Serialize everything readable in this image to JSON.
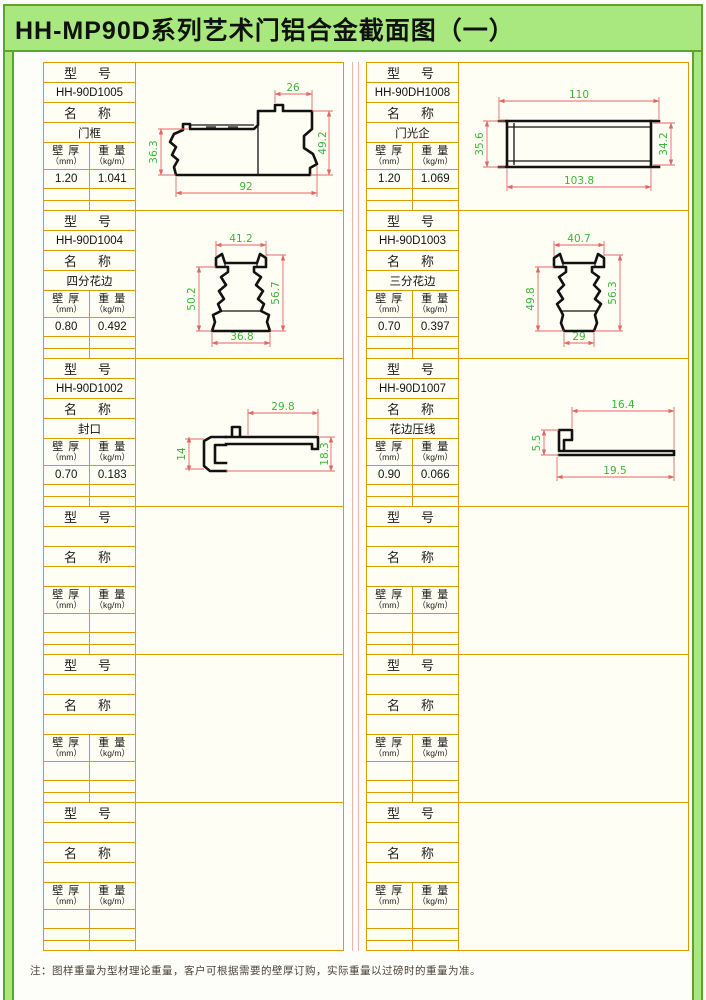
{
  "title": "HH-MP90D系列艺术门铝合金截面图（一）",
  "note": "注：图样重量为型材理论重量，客户可根据需要的壁厚订购，实际重量以过磅时的重量为准。",
  "labels": {
    "model_header": "型　号",
    "name_header": "名　称",
    "thickness_1": "壁 厚",
    "thickness_2": "（mm）",
    "weight_1": "重 量",
    "weight_2": "（kg/m）"
  },
  "colors": {
    "frame_green": "#a9e87e",
    "frame_edge_green": "#5ea32b",
    "table_border_orange": "#dd9a00",
    "cell_background": "#fffef4",
    "dimension_line_red": "#e06666",
    "dimension_text_green": "#3fb43a"
  },
  "entries_left": [
    {
      "model": "HH-90D1005",
      "name": "门框",
      "thickness": "1.20",
      "weight": "1.041",
      "dims": {
        "top": "26",
        "bottom": "92",
        "left": "36.3",
        "right": "49.2"
      }
    },
    {
      "model": "HH-90D1004",
      "name": "四分花边",
      "thickness": "0.80",
      "weight": "0.492",
      "dims": {
        "top": "41.2",
        "bottom": "36.8",
        "left": "50.2",
        "right": "56.7"
      }
    },
    {
      "model": "HH-90D1002",
      "name": "封口",
      "thickness": "0.70",
      "weight": "0.183",
      "dims": {
        "top": "29.8",
        "left": "14",
        "right": "18.3"
      }
    },
    {
      "model": "",
      "name": "",
      "thickness": "",
      "weight": ""
    },
    {
      "model": "",
      "name": "",
      "thickness": "",
      "weight": ""
    },
    {
      "model": "",
      "name": "",
      "thickness": "",
      "weight": ""
    }
  ],
  "entries_right": [
    {
      "model": "HH-90DH1008",
      "name": "门光企",
      "thickness": "1.20",
      "weight": "1.069",
      "dims": {
        "top": "110",
        "bottom": "103.8",
        "left": "35.6",
        "right": "34.2"
      }
    },
    {
      "model": "HH-90D1003",
      "name": "三分花边",
      "thickness": "0.70",
      "weight": "0.397",
      "dims": {
        "top": "40.7",
        "bottom": "29",
        "left": "49.8",
        "right": "56.3"
      }
    },
    {
      "model": "HH-90D1007",
      "name": "花边压线",
      "thickness": "0.90",
      "weight": "0.066",
      "dims": {
        "top": "16.4",
        "bottom": "19.5",
        "left": "5.5"
      }
    },
    {
      "model": "",
      "name": "",
      "thickness": "",
      "weight": ""
    },
    {
      "model": "",
      "name": "",
      "thickness": "",
      "weight": ""
    },
    {
      "model": "",
      "name": "",
      "thickness": "",
      "weight": ""
    }
  ]
}
